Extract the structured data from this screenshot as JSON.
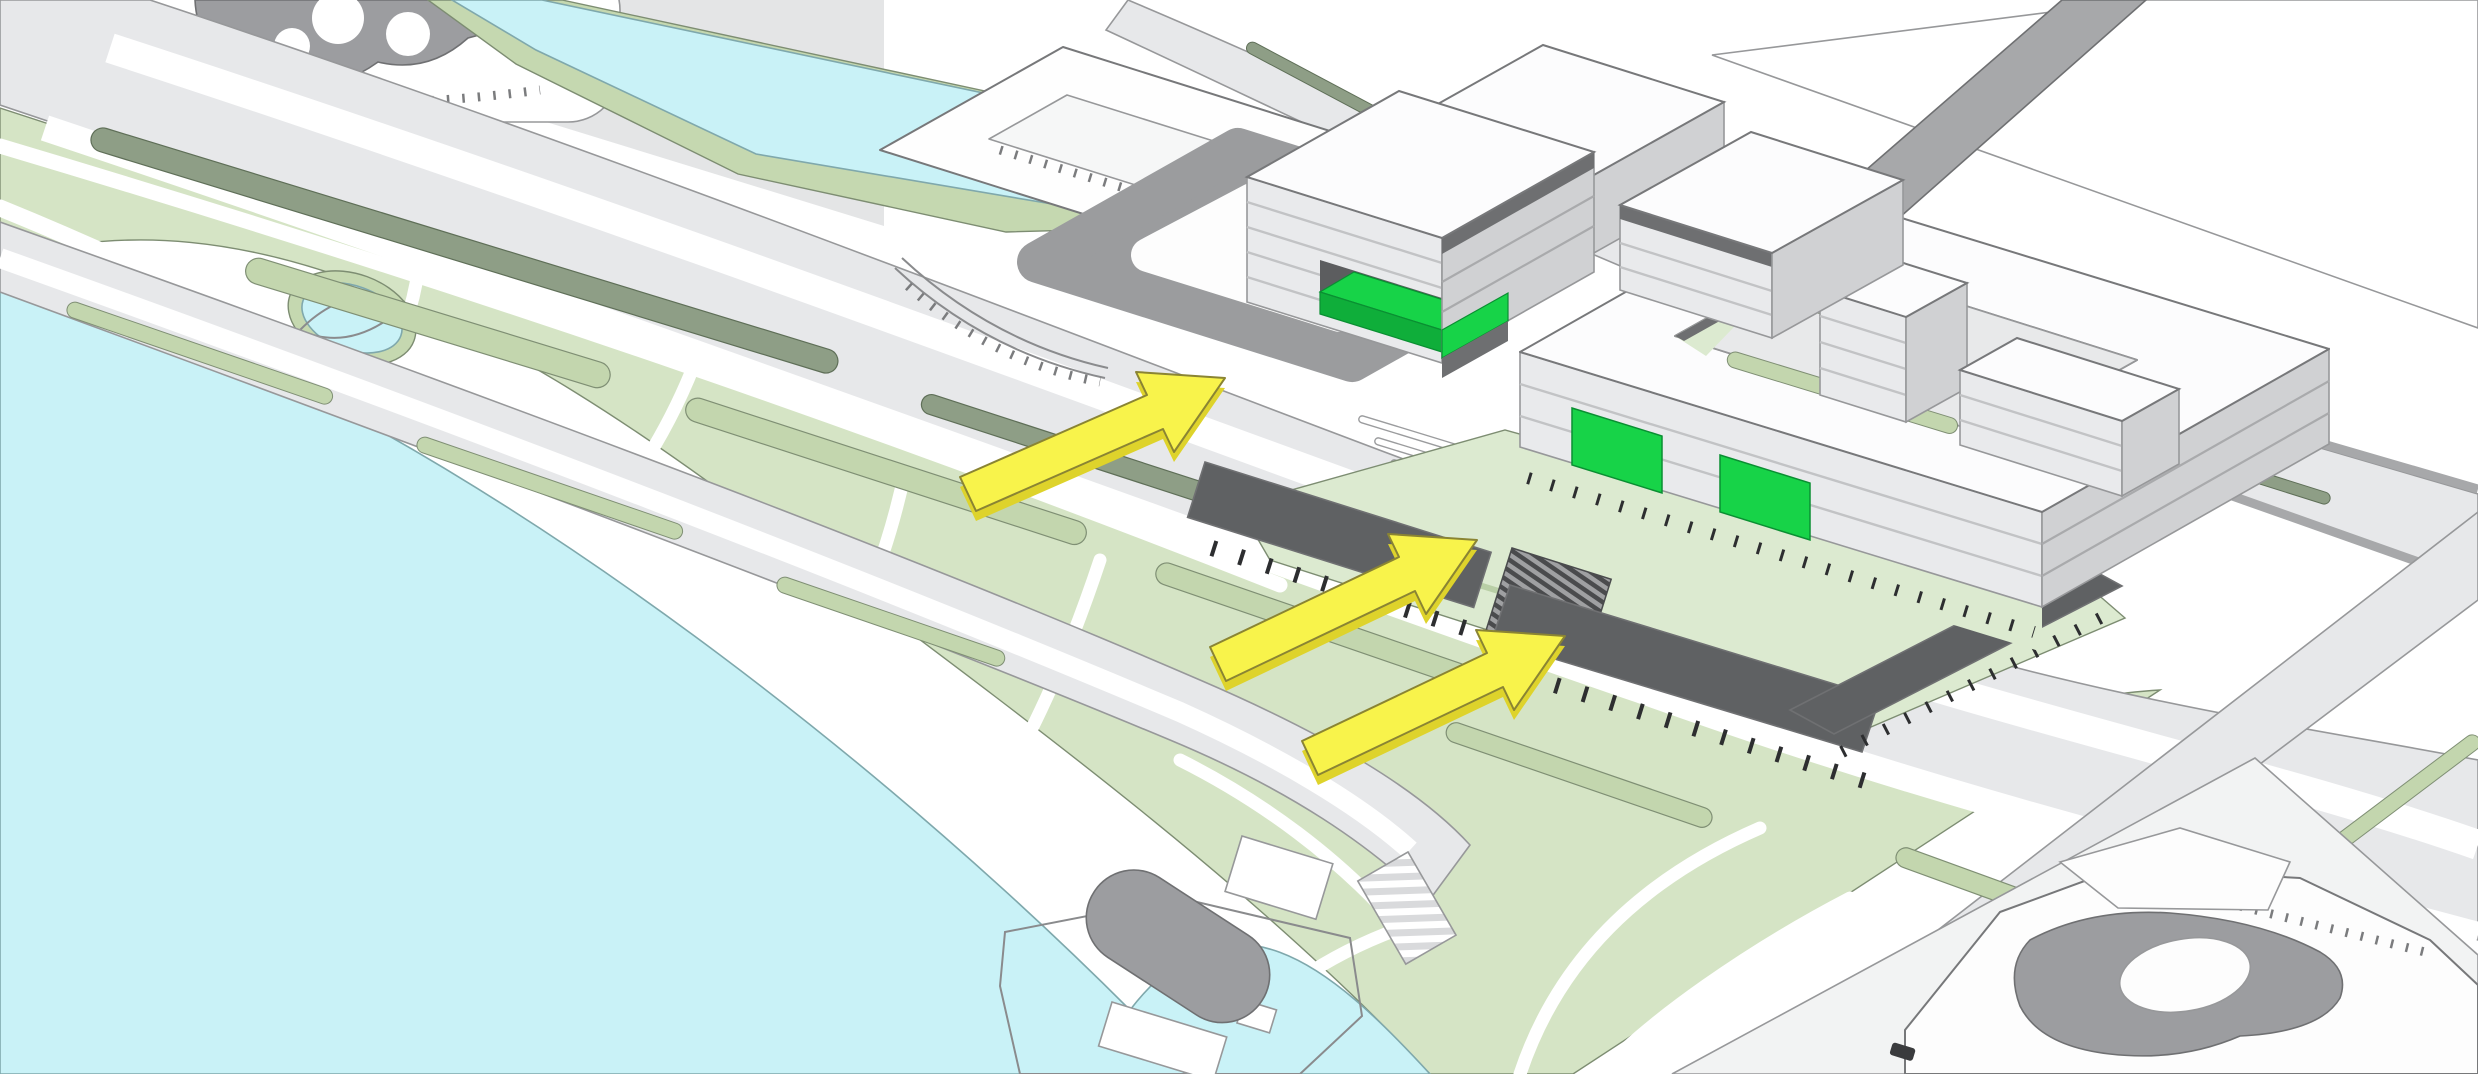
{
  "scene": {
    "kind": "architectural-axonometric-site-plan",
    "water_bodies": [
      "lake-southwest",
      "canal-northeast",
      "canal-basin",
      "park-pond"
    ],
    "green_spaces": [
      "waterfront-park",
      "boulevard-medians",
      "campus-lawn",
      "ring-courtyard-garden",
      "canal-banks"
    ],
    "buildings": [
      "north-building-with-green-entrance",
      "back-boxes",
      "courtyard-ring-building",
      "tower-slab",
      "east-slab",
      "existing-building-outlines",
      "historic-footprint-northwest",
      "historic-footprint-southeast",
      "pier-pavilions"
    ],
    "structures": [
      "elevated-dark-decks-on-columns",
      "stair-ramp",
      "zebra-crossing",
      "pier",
      "oval-pad",
      "bridges-over-canal"
    ],
    "annotation_meaning": "yellow arrows mark pedestrian access routes toward green-highlighted entrance volumes"
  },
  "arrows": {
    "count": 3,
    "items": [
      {
        "name": "access-arrow-north"
      },
      {
        "name": "access-arrow-middle"
      },
      {
        "name": "access-arrow-south"
      }
    ]
  },
  "highlights": {
    "count": 3,
    "items": [
      {
        "name": "north-building-entrance-volume"
      },
      {
        "name": "ring-building-west-facade-panel"
      },
      {
        "name": "ring-building-south-facade-panel"
      }
    ]
  },
  "colors": {
    "background": "#ffffff",
    "water": "#c9f2f7",
    "park": "#d5e4c5",
    "bank": "#c5d8b0",
    "lawn": "#dcead0",
    "medianDark": "#8e9e86",
    "medianLight": "#c3d6ae",
    "roadLight": "#e7e8ea",
    "roadDark": "#a7a8aa",
    "plaza": "#9b9c9e",
    "deck": "#5f6163",
    "column": "#2d2e30",
    "face": "#e9eaec",
    "faceSide": "#d0d1d3",
    "bandDark": "#6e6f71",
    "roof": "#fcfcfd",
    "green": "#17d348",
    "greenDark": "#0fae3a",
    "arrow": "#f8f34b",
    "arrowSide": "#ded32b",
    "footprint": "#9c9da0",
    "white": "#fdfdfd"
  }
}
